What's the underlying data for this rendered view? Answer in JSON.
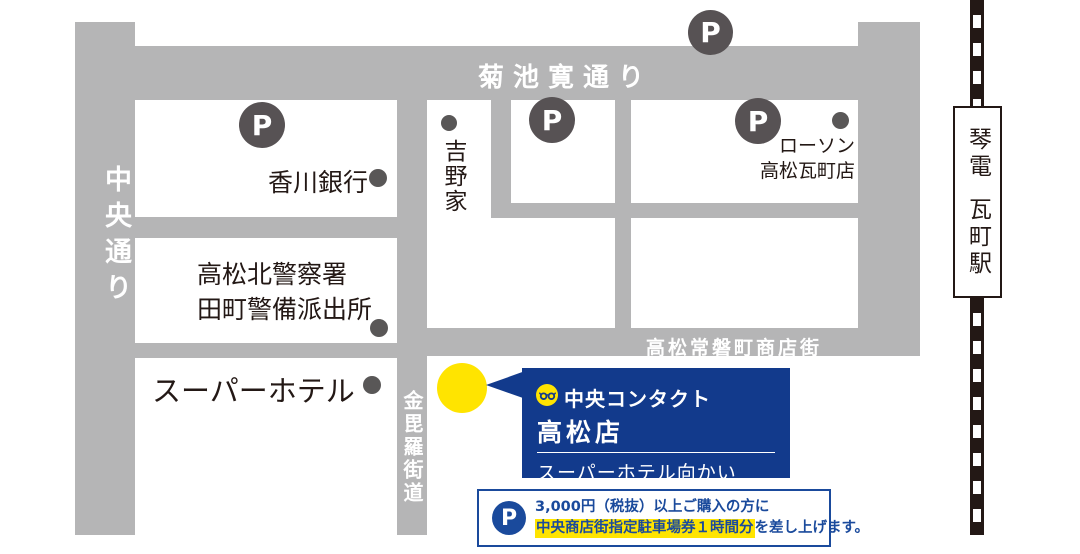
{
  "streets": {
    "chuo_dori": "中央通り",
    "kikuchi_kan_dori": "菊池寛通り",
    "konpira_kaido": "金毘羅街道",
    "tokiwacho_shotengai": "高松常磐町商店街"
  },
  "landmarks": {
    "kagawa_bank": "香川銀行",
    "yoshinoya": "吉野家",
    "lawson_line1": "ローソン",
    "lawson_line2": "高松瓦町店",
    "police_line1": "高松北警察署",
    "police_line2": "田町警備派出所",
    "super_hotel": "スーパーホテル"
  },
  "station": {
    "railway_name": "琴電",
    "station_name": "瓦町駅"
  },
  "parking_marker": "P",
  "store_box": {
    "brand": "中央コンタクト",
    "store_name": "高松店",
    "note": "スーパーホテル向かい"
  },
  "parking_note": {
    "marker": "P",
    "line1": "3,000円（税抜）以上ご購入の方に",
    "line2_highlight": "中央商店街指定駐車場券１時間分",
    "line2_rest": "を差し上げます。"
  },
  "colors": {
    "street_gray": "#b5b5b6",
    "marker_gray": "#575254",
    "text_dark": "#231815",
    "brand_blue": "#123a8c",
    "note_blue": "#1a4a9c",
    "accent_yellow": "#ffe400"
  }
}
